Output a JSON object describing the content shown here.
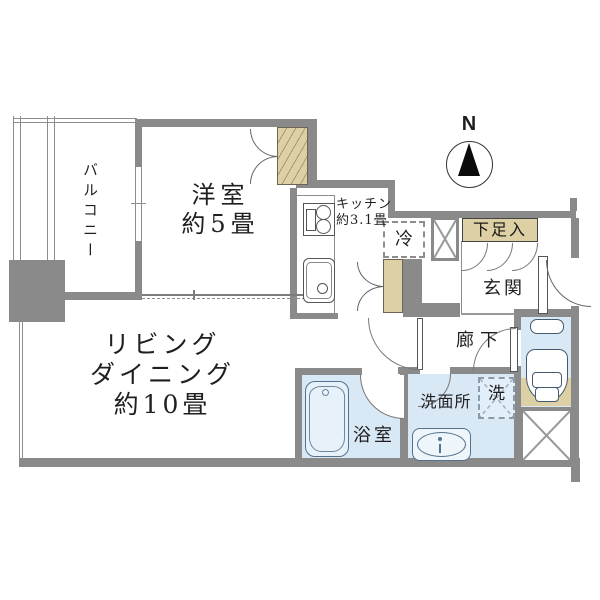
{
  "floorplan": {
    "compass": {
      "north_label": "N"
    },
    "labels": {
      "balcony": "バルコニー",
      "western_room_line1": "洋室",
      "western_room_line2": "約5畳",
      "living_line1": "リビング",
      "living_line2": "ダイニング",
      "living_line3": "約10畳",
      "kitchen_line1": "キッチン",
      "kitchen_line2": "約3.1畳",
      "refrigerator": "冷",
      "shoe_cabinet": "下足入",
      "entrance": "玄関",
      "hallway": "廊下",
      "washroom": "洗面所",
      "washer": "洗",
      "bathroom": "浴室"
    },
    "colors": {
      "wall": "#8a8a8a",
      "water_area": "#d9e8f5",
      "storage": "#ddd0a4"
    }
  }
}
